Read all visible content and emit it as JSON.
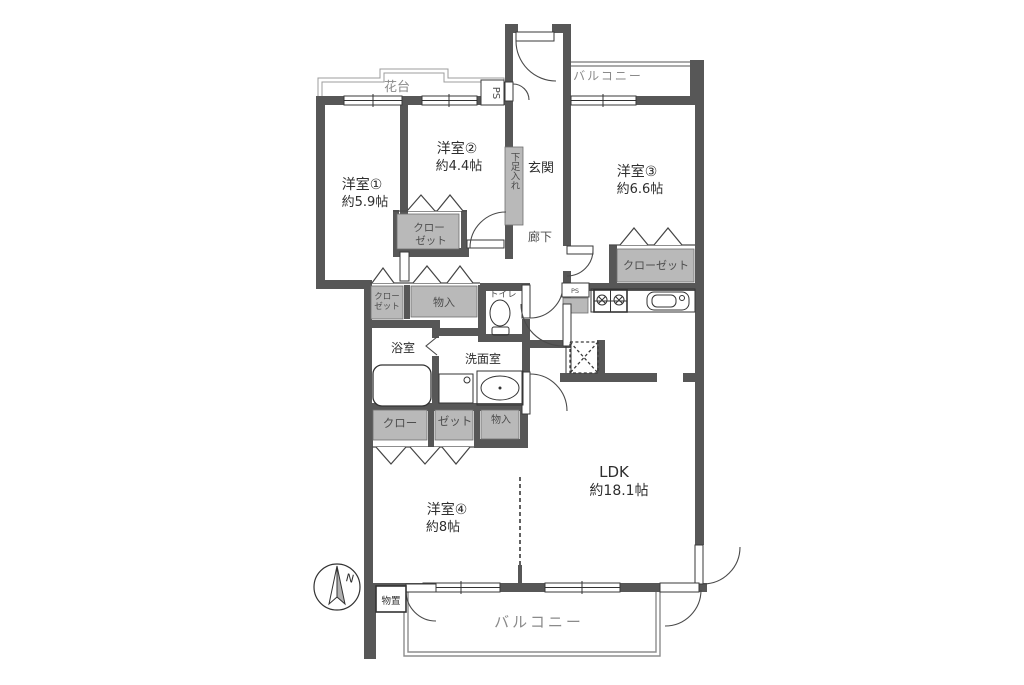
{
  "colors": {
    "wall": "#575757",
    "storage_fill": "#b9b9b9",
    "background": "#ffffff",
    "label_gray": "#8a8a8a"
  },
  "labels": {
    "hanadai": "花台",
    "ps_top": "PS",
    "balcony_top": "バルコニー",
    "genkan": "玄関",
    "shoe_box": "下足入れ",
    "corridor": "廊下",
    "room1_name": "洋室①",
    "room1_size": "約5.9帖",
    "room2_name": "洋室②",
    "room2_size": "約4.4帖",
    "room3_name": "洋室③",
    "room3_size": "約6.6帖",
    "room4_name": "洋室④",
    "room4_size": "約8帖",
    "ldk_name": "LDK",
    "ldk_size": "約18.1帖",
    "closet_room2_line1": "クロー",
    "closet_room2_line2": "ゼット",
    "closet_room3": "クローゼット",
    "closet_small_line1": "クロー",
    "closet_small_line2": "ゼット",
    "storage1": "物入",
    "storage2": "物入",
    "toilet": "トイレ",
    "bath": "浴室",
    "washroom": "洗面室",
    "closet_room4_left": "クロー",
    "closet_room4_right": "ゼット",
    "ps_kitchen": "PS",
    "storage_shed": "物置",
    "balcony_bottom": "バルコニー",
    "compass_north": "N"
  }
}
